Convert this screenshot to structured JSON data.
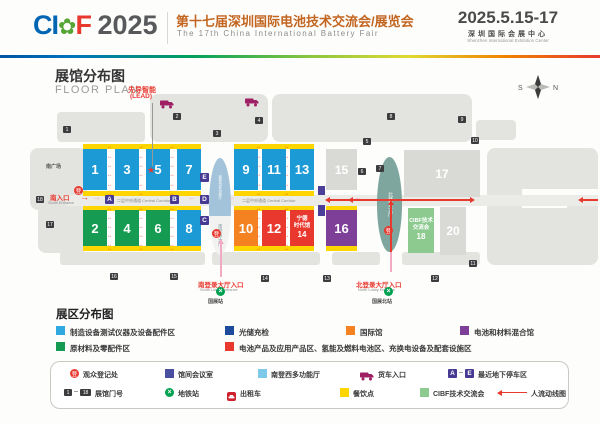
{
  "colors": {
    "blue": "#1b9ad6",
    "green": "#169c52",
    "orange": "#f58220",
    "red": "#e9392f",
    "purple": "#7d3f97",
    "gray": "#d9dad6",
    "ltgreen": "#8cca8f",
    "yellow": "#ffd500",
    "meeting": "#4b3f99",
    "marker": "#473a92",
    "accent_red": "#e8392f"
  },
  "header": {
    "logo_ci": "CI",
    "logo_flower": "✿",
    "logo_f": "F",
    "logo_year": "2025",
    "title_cn": "第十七届深圳国际电池技术交流会/展览会",
    "title_en": "The 17th China International Battery Fair",
    "dates": "2025.5.15-17",
    "venue_cn": "深圳国际会展中心",
    "venue_en": "Shenzhen International Exhibition Center"
  },
  "plan": {
    "title_cn": "展馆分布图",
    "title_en": "FLOOR PLAN",
    "compass_s": "S",
    "compass_n": "N",
    "lead_cn": "先导智能",
    "lead_en": "(LEAD)",
    "star": "★",
    "south_plaza": "南广场",
    "corridor_label": "二层中央通道 Central Corridor",
    "reg_glyph": "登",
    "metro_glyph": "×",
    "south_lobby_top": "南登西多功能厅",
    "south_lobby": "南登录大厅",
    "north_lobby": "北登录大厅",
    "ent_south_cn": "南入口",
    "ent_south_en": "South Entrance",
    "ent_slobby_cn": "南登录大厅入口",
    "ent_slobby_en": "South Lobby Entrance",
    "station_south": "国展站",
    "ent_nlobby_cn": "北登录大厅入口",
    "ent_nlobby_en": "North Lobby Entrance",
    "station_north": "国展北站",
    "halls": [
      {
        "n": "1",
        "x": 83,
        "y": 149,
        "w": 24,
        "h": 41,
        "c": "blue"
      },
      {
        "n": "3",
        "x": 115,
        "y": 149,
        "w": 24,
        "h": 41,
        "c": "blue"
      },
      {
        "n": "5",
        "x": 146,
        "y": 149,
        "w": 24,
        "h": 41,
        "c": "blue"
      },
      {
        "n": "7",
        "x": 177,
        "y": 149,
        "w": 24,
        "h": 41,
        "c": "blue"
      },
      {
        "n": "9",
        "x": 234,
        "y": 149,
        "w": 24,
        "h": 41,
        "c": "blue"
      },
      {
        "n": "11",
        "x": 262,
        "y": 149,
        "w": 24,
        "h": 41,
        "c": "blue"
      },
      {
        "n": "13",
        "x": 290,
        "y": 149,
        "w": 24,
        "h": 41,
        "c": "blue"
      },
      {
        "n": "15",
        "x": 326,
        "y": 149,
        "w": 31,
        "h": 41,
        "c": "gray"
      },
      {
        "n": "2",
        "x": 83,
        "y": 210,
        "w": 24,
        "h": 36,
        "c": "green"
      },
      {
        "n": "4",
        "x": 115,
        "y": 210,
        "w": 24,
        "h": 36,
        "c": "green"
      },
      {
        "n": "6",
        "x": 146,
        "y": 210,
        "w": 24,
        "h": 36,
        "c": "green"
      },
      {
        "n": "8",
        "x": 177,
        "y": 210,
        "w": 24,
        "h": 36,
        "c": "blue"
      },
      {
        "n": "10",
        "x": 234,
        "y": 210,
        "w": 24,
        "h": 36,
        "c": "orange"
      },
      {
        "n": "12",
        "x": 262,
        "y": 210,
        "w": 24,
        "h": 36,
        "c": "red"
      },
      {
        "n": "14",
        "x": 290,
        "y": 210,
        "w": 24,
        "h": 36,
        "c": "red",
        "lines": [
          "宁德",
          "时代馆",
          "14"
        ]
      },
      {
        "n": "16",
        "x": 326,
        "y": 210,
        "w": 31,
        "h": 36,
        "c": "purple"
      },
      {
        "n": "17",
        "x": 404,
        "y": 150,
        "w": 76,
        "h": 47,
        "c": "gray"
      },
      {
        "n": "18",
        "x": 408,
        "y": 208,
        "w": 26,
        "h": 45,
        "c": "ltgreen",
        "lines": [
          "CIBF技术",
          "交流会",
          "18"
        ]
      },
      {
        "n": "20",
        "x": 440,
        "y": 207,
        "w": 26,
        "h": 48,
        "c": "gray"
      }
    ],
    "gates": [
      {
        "n": "1",
        "x": 63,
        "y": 126
      },
      {
        "n": "2",
        "x": 173,
        "y": 113
      },
      {
        "n": "3",
        "x": 213,
        "y": 130
      },
      {
        "n": "4",
        "x": 255,
        "y": 117
      },
      {
        "n": "5",
        "x": 363,
        "y": 138
      },
      {
        "n": "6",
        "x": 358,
        "y": 168
      },
      {
        "n": "7",
        "x": 376,
        "y": 165
      },
      {
        "n": "8",
        "x": 387,
        "y": 113
      },
      {
        "n": "9",
        "x": 458,
        "y": 116
      },
      {
        "n": "10",
        "x": 471,
        "y": 137
      },
      {
        "n": "11",
        "x": 469,
        "y": 260
      },
      {
        "n": "12",
        "x": 431,
        "y": 275
      },
      {
        "n": "13",
        "x": 323,
        "y": 275
      },
      {
        "n": "14",
        "x": 261,
        "y": 275
      },
      {
        "n": "15",
        "x": 170,
        "y": 273
      },
      {
        "n": "16",
        "x": 110,
        "y": 273
      },
      {
        "n": "17",
        "x": 46,
        "y": 221
      },
      {
        "n": "18",
        "x": 36,
        "y": 196
      }
    ],
    "markers": [
      {
        "t": "A",
        "x": 105,
        "y": 195
      },
      {
        "t": "B",
        "x": 170,
        "y": 195
      },
      {
        "t": "E",
        "x": 200,
        "y": 173
      },
      {
        "t": "D",
        "x": 200,
        "y": 195
      },
      {
        "t": "C",
        "x": 200,
        "y": 216
      }
    ]
  },
  "zones": {
    "title": "展区分布图",
    "items": [
      {
        "x": 56,
        "y": 326,
        "color": "#30a8e0",
        "label": "制造设备测试仪器及设备配件区"
      },
      {
        "x": 225,
        "y": 326,
        "color": "#1c4b9c",
        "label": "光储充检"
      },
      {
        "x": 346,
        "y": 326,
        "color": "#f58220",
        "label": "国际馆"
      },
      {
        "x": 460,
        "y": 326,
        "color": "#7d3f97",
        "label": "电池和材料混合馆"
      },
      {
        "x": 56,
        "y": 342,
        "color": "#169c52",
        "label": "原材料及零配件区"
      },
      {
        "x": 225,
        "y": 342,
        "color": "#e9392f",
        "label": "电池产品及应用产品区、氢能及燃料电池区、充换电设备及配套设施区"
      }
    ]
  },
  "key": {
    "row1": [
      {
        "icon": "reg",
        "x": 70,
        "label": "观众登记处"
      },
      {
        "icon": "swatch",
        "color": "#4b4fa0",
        "x": 165,
        "label": "馆间会议室"
      },
      {
        "icon": "swatch",
        "color": "#7fc9e8",
        "x": 258,
        "label": "南登西多功能厅"
      },
      {
        "icon": "truck",
        "x": 360,
        "label": "货车入口"
      },
      {
        "icon": "ae",
        "x": 448,
        "label": "最近地下停车区",
        "a": "A",
        "e": "E"
      }
    ],
    "row2": [
      {
        "icon": "range",
        "x": 64,
        "label": "展馆门号",
        "from": "1",
        "to": "18"
      },
      {
        "icon": "metro",
        "x": 165,
        "label": "地铁站"
      },
      {
        "icon": "taxi",
        "x": 227,
        "label": "出租车"
      },
      {
        "icon": "swatch",
        "color": "#ffd500",
        "x": 340,
        "label": "餐饮点"
      },
      {
        "icon": "swatch",
        "color": "#8cca8f",
        "x": 420,
        "label": "CIBF技术交流会"
      },
      {
        "icon": "flow",
        "x": 497,
        "label": "人流动线图"
      }
    ]
  }
}
